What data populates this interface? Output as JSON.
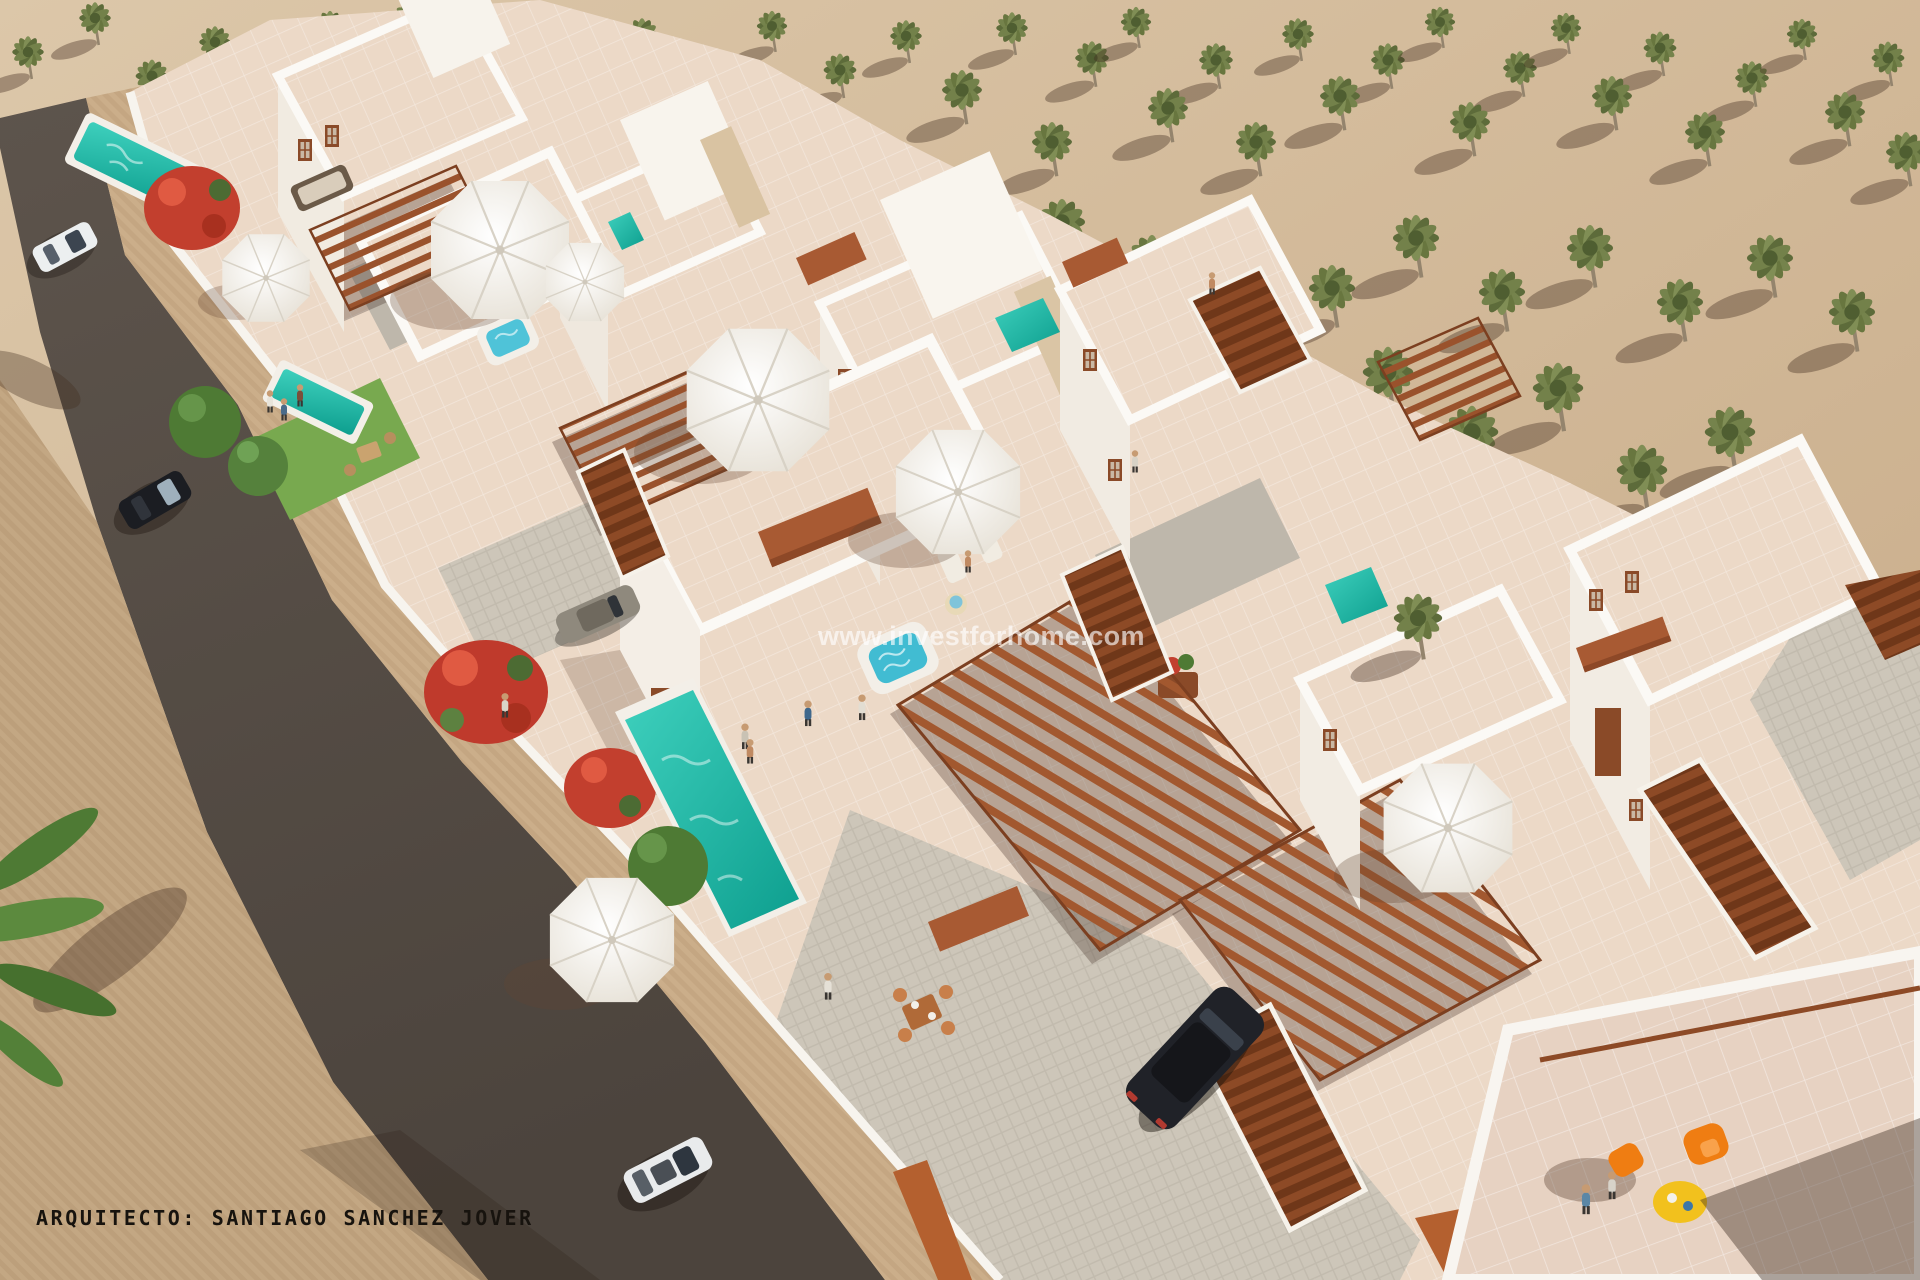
{
  "scene": {
    "kind": "aerial 3D architectural render of a white villa development with pools, pergolas, palm grove and street"
  },
  "watermark": {
    "text": "www.investforhome.com"
  },
  "credit": {
    "text": "ARQUITECTO: SANTIAGO SANCHEZ JOVER"
  },
  "palette": {
    "sand": "#d5bd9e",
    "road": "#564d45",
    "pavement": "#c3a783",
    "sidewalk": "#cbae8a",
    "wall_white": "#f6f3ed",
    "terrace_pink": "#ecd9c7",
    "pool_teal": "#14b3a2",
    "jacuzzi_blue": "#4fc3d8",
    "terracotta": "#a85a33",
    "pergola_brown": "#94502b",
    "palm_green": "#6d7b45",
    "lawn_green": "#78a94f",
    "flower_red": "#c23f2e",
    "chair_orange": "#ef7d12",
    "table_yellow": "#f2c11d",
    "car_dark": "#1d1f24",
    "car_white": "#e9ebec"
  }
}
